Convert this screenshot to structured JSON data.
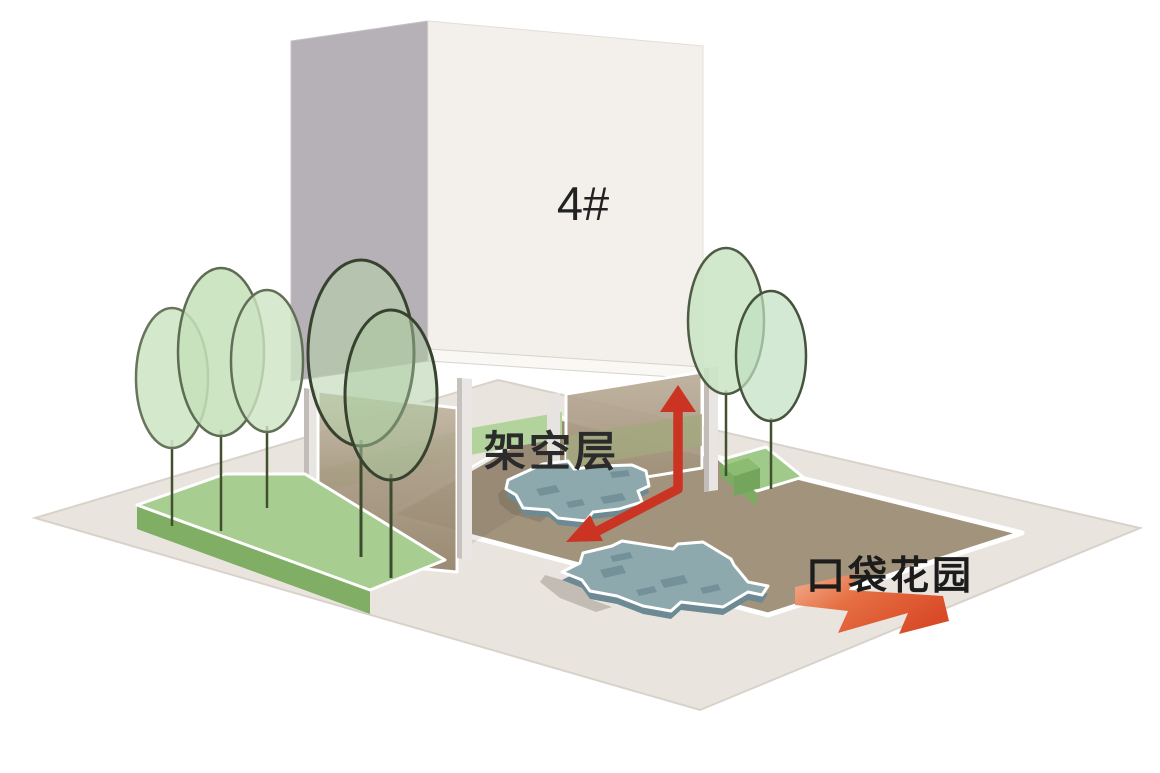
{
  "diagram": {
    "building_label": "4#",
    "stilt_floor_label": "架空层",
    "pocket_garden_label": "口袋花园"
  },
  "colors": {
    "background": "#ffffff",
    "ground_plane": "#e9e4de",
    "courtyard_paving": "#a2947c",
    "planter_green_top": "#a7cd90",
    "planter_green_side": "#7fae64",
    "tree_canopy_green": "#c9e2bd",
    "building_front_face": "#f3f0eb",
    "building_side_face": "#b6b1b7",
    "stilt_wall_brown": "#a59681",
    "platform_blue": "#8ea9ae",
    "route_arrow_red": "#cb3423",
    "garden_arrow_orange": "#e0552f",
    "label_text": "#222222"
  },
  "annotations": {
    "route_arrow": "bent red double-headed arrow through stilt floor",
    "garden_arrow": "orange chevron arrow pointing to pocket garden",
    "tree_count": 7,
    "platform_count": 2
  }
}
